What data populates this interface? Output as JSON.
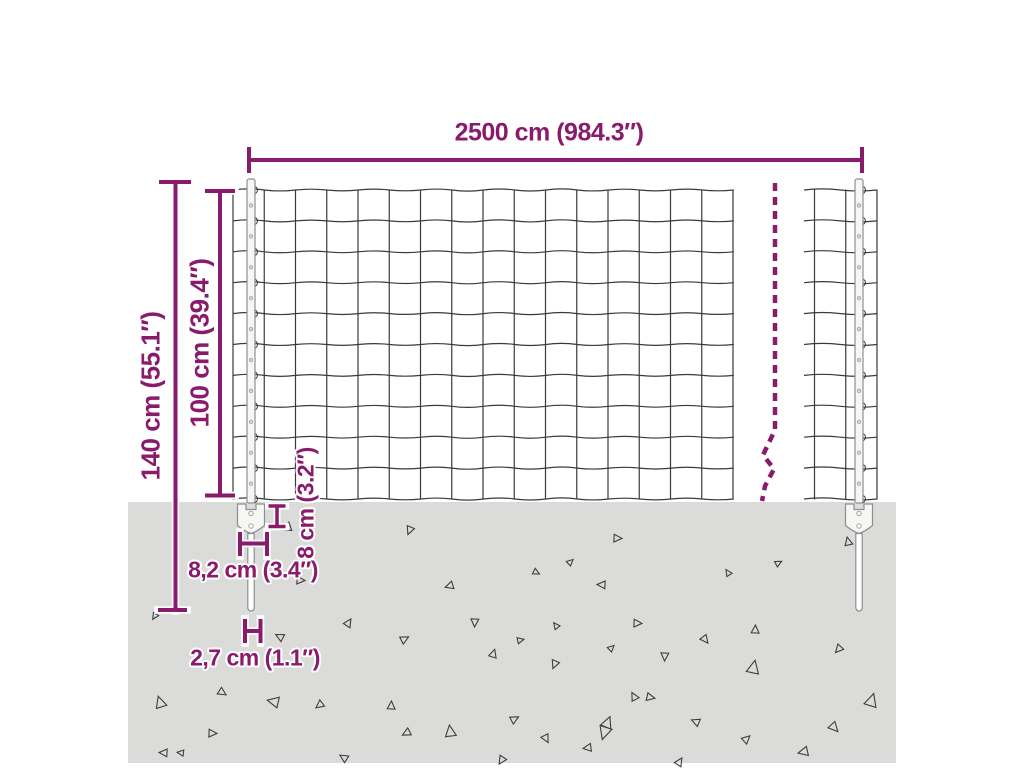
{
  "diagram": {
    "type": "product-dimension-diagram",
    "subject": "wire mesh fence with anchor posts",
    "labels": {
      "total_width": "2500 cm (984.3″)",
      "total_height": "140 cm (55.1″)",
      "fence_height": "100 cm (39.4″)",
      "anchor_depth": "8 cm (3.2″)",
      "anchor_width": "8,2 cm (3.4″)",
      "spike_width": "2,7 cm (1.1″)"
    },
    "structure": {
      "posts": 2,
      "mesh_rows": 10,
      "mesh_columns": 16,
      "break_indicator_dashed_line": true,
      "ground_shown": true
    },
    "colors": {
      "dimension": "#8a1a6b",
      "ground": "#dbdbda",
      "mesh": "#3a3a3a",
      "post_fill": "#f6f6f4",
      "post_stroke": "#8f8f8f",
      "triangle": "#3e3e3e",
      "background": "#ffffff"
    },
    "ground_triangles": [
      {
        "x": 288,
        "y": 527,
        "s": 5,
        "r": 10
      },
      {
        "x": 410,
        "y": 530,
        "s": 5,
        "r": 205
      },
      {
        "x": 617,
        "y": 538,
        "s": 5,
        "r": 95
      },
      {
        "x": 848,
        "y": 542,
        "s": 5,
        "r": 350
      },
      {
        "x": 536,
        "y": 572,
        "s": 4,
        "r": 120
      },
      {
        "x": 570,
        "y": 562,
        "s": 4,
        "r": 50
      },
      {
        "x": 778,
        "y": 563,
        "s": 4,
        "r": 65
      },
      {
        "x": 728,
        "y": 573,
        "s": 4,
        "r": 330
      },
      {
        "x": 602,
        "y": 585,
        "s": 5,
        "r": 275
      },
      {
        "x": 300,
        "y": 580,
        "s": 5,
        "r": 95
      },
      {
        "x": 450,
        "y": 586,
        "s": 5,
        "r": 255
      },
      {
        "x": 348,
        "y": 623,
        "s": 5,
        "r": 35
      },
      {
        "x": 280,
        "y": 637,
        "s": 5,
        "r": 300
      },
      {
        "x": 475,
        "y": 622,
        "s": 5,
        "r": 185
      },
      {
        "x": 404,
        "y": 639,
        "s": 5,
        "r": 65
      },
      {
        "x": 637,
        "y": 623,
        "s": 5,
        "r": 95
      },
      {
        "x": 705,
        "y": 639,
        "s": 5,
        "r": 145
      },
      {
        "x": 755,
        "y": 630,
        "s": 5,
        "r": 5
      },
      {
        "x": 839,
        "y": 649,
        "s": 5,
        "r": 225
      },
      {
        "x": 493,
        "y": 654,
        "s": 5,
        "r": 20
      },
      {
        "x": 520,
        "y": 640,
        "s": 4,
        "r": 80
      },
      {
        "x": 555,
        "y": 664,
        "s": 5,
        "r": 205
      },
      {
        "x": 556,
        "y": 626,
        "s": 4,
        "r": 325
      },
      {
        "x": 611,
        "y": 648,
        "s": 4,
        "r": 50
      },
      {
        "x": 665,
        "y": 656,
        "s": 5,
        "r": 185
      },
      {
        "x": 753,
        "y": 668,
        "s": 8,
        "r": 15
      },
      {
        "x": 160,
        "y": 703,
        "s": 7,
        "r": 345
      },
      {
        "x": 222,
        "y": 692,
        "s": 5,
        "r": 125
      },
      {
        "x": 274,
        "y": 702,
        "s": 7,
        "r": 285
      },
      {
        "x": 320,
        "y": 705,
        "s": 5,
        "r": 235
      },
      {
        "x": 391,
        "y": 706,
        "s": 5,
        "r": 5
      },
      {
        "x": 212,
        "y": 733,
        "s": 5,
        "r": 95
      },
      {
        "x": 164,
        "y": 753,
        "s": 5,
        "r": 275
      },
      {
        "x": 344,
        "y": 758,
        "s": 5,
        "r": 305
      },
      {
        "x": 407,
        "y": 733,
        "s": 5,
        "r": 245
      },
      {
        "x": 450,
        "y": 732,
        "s": 7,
        "r": 355
      },
      {
        "x": 514,
        "y": 719,
        "s": 5,
        "r": 65
      },
      {
        "x": 546,
        "y": 738,
        "s": 5,
        "r": 155
      },
      {
        "x": 588,
        "y": 748,
        "s": 5,
        "r": 265
      },
      {
        "x": 607,
        "y": 723,
        "s": 7,
        "r": 25
      },
      {
        "x": 634,
        "y": 697,
        "s": 5,
        "r": 335
      },
      {
        "x": 502,
        "y": 760,
        "s": 5,
        "r": 215
      },
      {
        "x": 650,
        "y": 697,
        "s": 5,
        "r": 105
      },
      {
        "x": 871,
        "y": 701,
        "s": 8,
        "r": 20
      },
      {
        "x": 696,
        "y": 722,
        "s": 5,
        "r": 295
      },
      {
        "x": 605,
        "y": 732,
        "s": 8,
        "r": 200
      },
      {
        "x": 746,
        "y": 739,
        "s": 5,
        "r": 50
      },
      {
        "x": 834,
        "y": 727,
        "s": 6,
        "r": 140
      },
      {
        "x": 804,
        "y": 752,
        "s": 6,
        "r": 260
      },
      {
        "x": 679,
        "y": 762,
        "s": 5,
        "r": 35
      },
      {
        "x": 155,
        "y": 616,
        "s": 4,
        "r": 215
      },
      {
        "x": 181,
        "y": 753,
        "s": 4,
        "r": 280
      }
    ]
  }
}
